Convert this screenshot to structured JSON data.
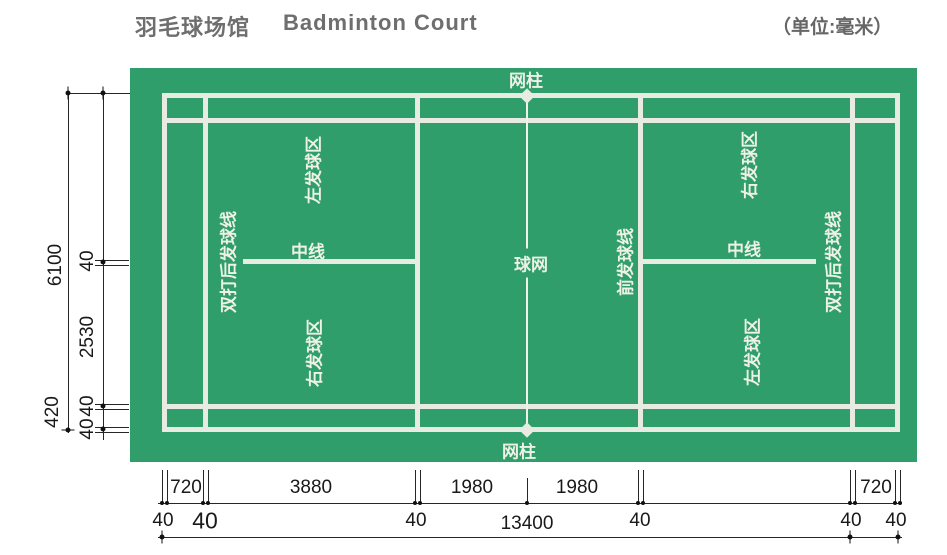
{
  "header": {
    "title_zh": "羽毛球场馆",
    "title_en": "Badminton Court",
    "unit_label": "（单位:毫米）"
  },
  "court_labels": {
    "net_post_top": "网柱",
    "net_post_bottom": "网柱",
    "net": "球网",
    "center_left": "中线",
    "center_right": "中线",
    "front_service_line": "前发球线",
    "zone_top_left": "左发球区",
    "zone_bottom_left": "右发球区",
    "zone_top_right": "右发球区",
    "zone_bottom_right": "左发球区",
    "doubles_long_service_left": "双打后发球线",
    "doubles_long_service_right": "双打后发球线"
  },
  "dims_left": [
    "6100",
    "40",
    "2530",
    "420",
    "40",
    "40"
  ],
  "dims_bottom": [
    "720",
    "3880",
    "1980",
    "1980",
    "720"
  ],
  "dims_forties": [
    "40",
    "40",
    "40",
    "40",
    "40",
    "40"
  ],
  "dims_total": "13400",
  "colors": {
    "mat_green": "#2f9e6a",
    "court_line": "#e8ebe1",
    "dimension_ink": "#191919",
    "title_gray": "#6e6e6e"
  }
}
